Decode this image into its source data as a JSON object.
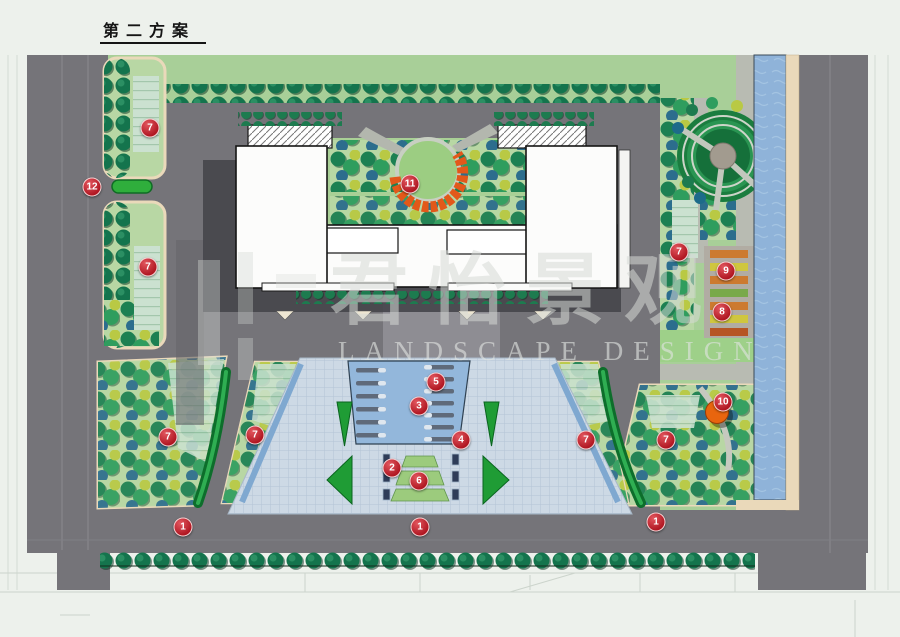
{
  "page": {
    "title": "第二方案",
    "background": "#edf1ec"
  },
  "watermark": {
    "cjk": "君怡景观",
    "latin": "LANDSCAPE DESIGN"
  },
  "plan": {
    "colors": {
      "page-bg": "#edf1ec",
      "road": "#757479",
      "road-line": "#8b8a90",
      "lawn": "#a8cf98",
      "planting": "#b8d7a4",
      "plaza": "#cdd9e5",
      "pool": "#93b7db",
      "river": "#8fb3d9",
      "tan": "#ead9ba",
      "parking": "#cbe1d0",
      "hedge": "#0d6e2b",
      "building": "#fcfcfb",
      "shadow": "#46464c",
      "orange": "#e2581a",
      "marker": "#b01722"
    },
    "markers": [
      {
        "label": "7",
        "x": 150,
        "y": 128
      },
      {
        "label": "12",
        "x": 92,
        "y": 187
      },
      {
        "label": "11",
        "x": 410,
        "y": 184
      },
      {
        "label": "7",
        "x": 148,
        "y": 267
      },
      {
        "label": "7",
        "x": 679,
        "y": 252
      },
      {
        "label": "9",
        "x": 726,
        "y": 271
      },
      {
        "label": "8",
        "x": 722,
        "y": 312
      },
      {
        "label": "5",
        "x": 436,
        "y": 382
      },
      {
        "label": "3",
        "x": 419,
        "y": 406
      },
      {
        "label": "10",
        "x": 723,
        "y": 402
      },
      {
        "label": "4",
        "x": 461,
        "y": 440
      },
      {
        "label": "7",
        "x": 168,
        "y": 437
      },
      {
        "label": "7",
        "x": 255,
        "y": 435
      },
      {
        "label": "7",
        "x": 586,
        "y": 440
      },
      {
        "label": "7",
        "x": 666,
        "y": 440
      },
      {
        "label": "2",
        "x": 392,
        "y": 468
      },
      {
        "label": "6",
        "x": 419,
        "y": 481
      },
      {
        "label": "1",
        "x": 183,
        "y": 527
      },
      {
        "label": "1",
        "x": 420,
        "y": 527
      },
      {
        "label": "1",
        "x": 656,
        "y": 522
      }
    ]
  }
}
